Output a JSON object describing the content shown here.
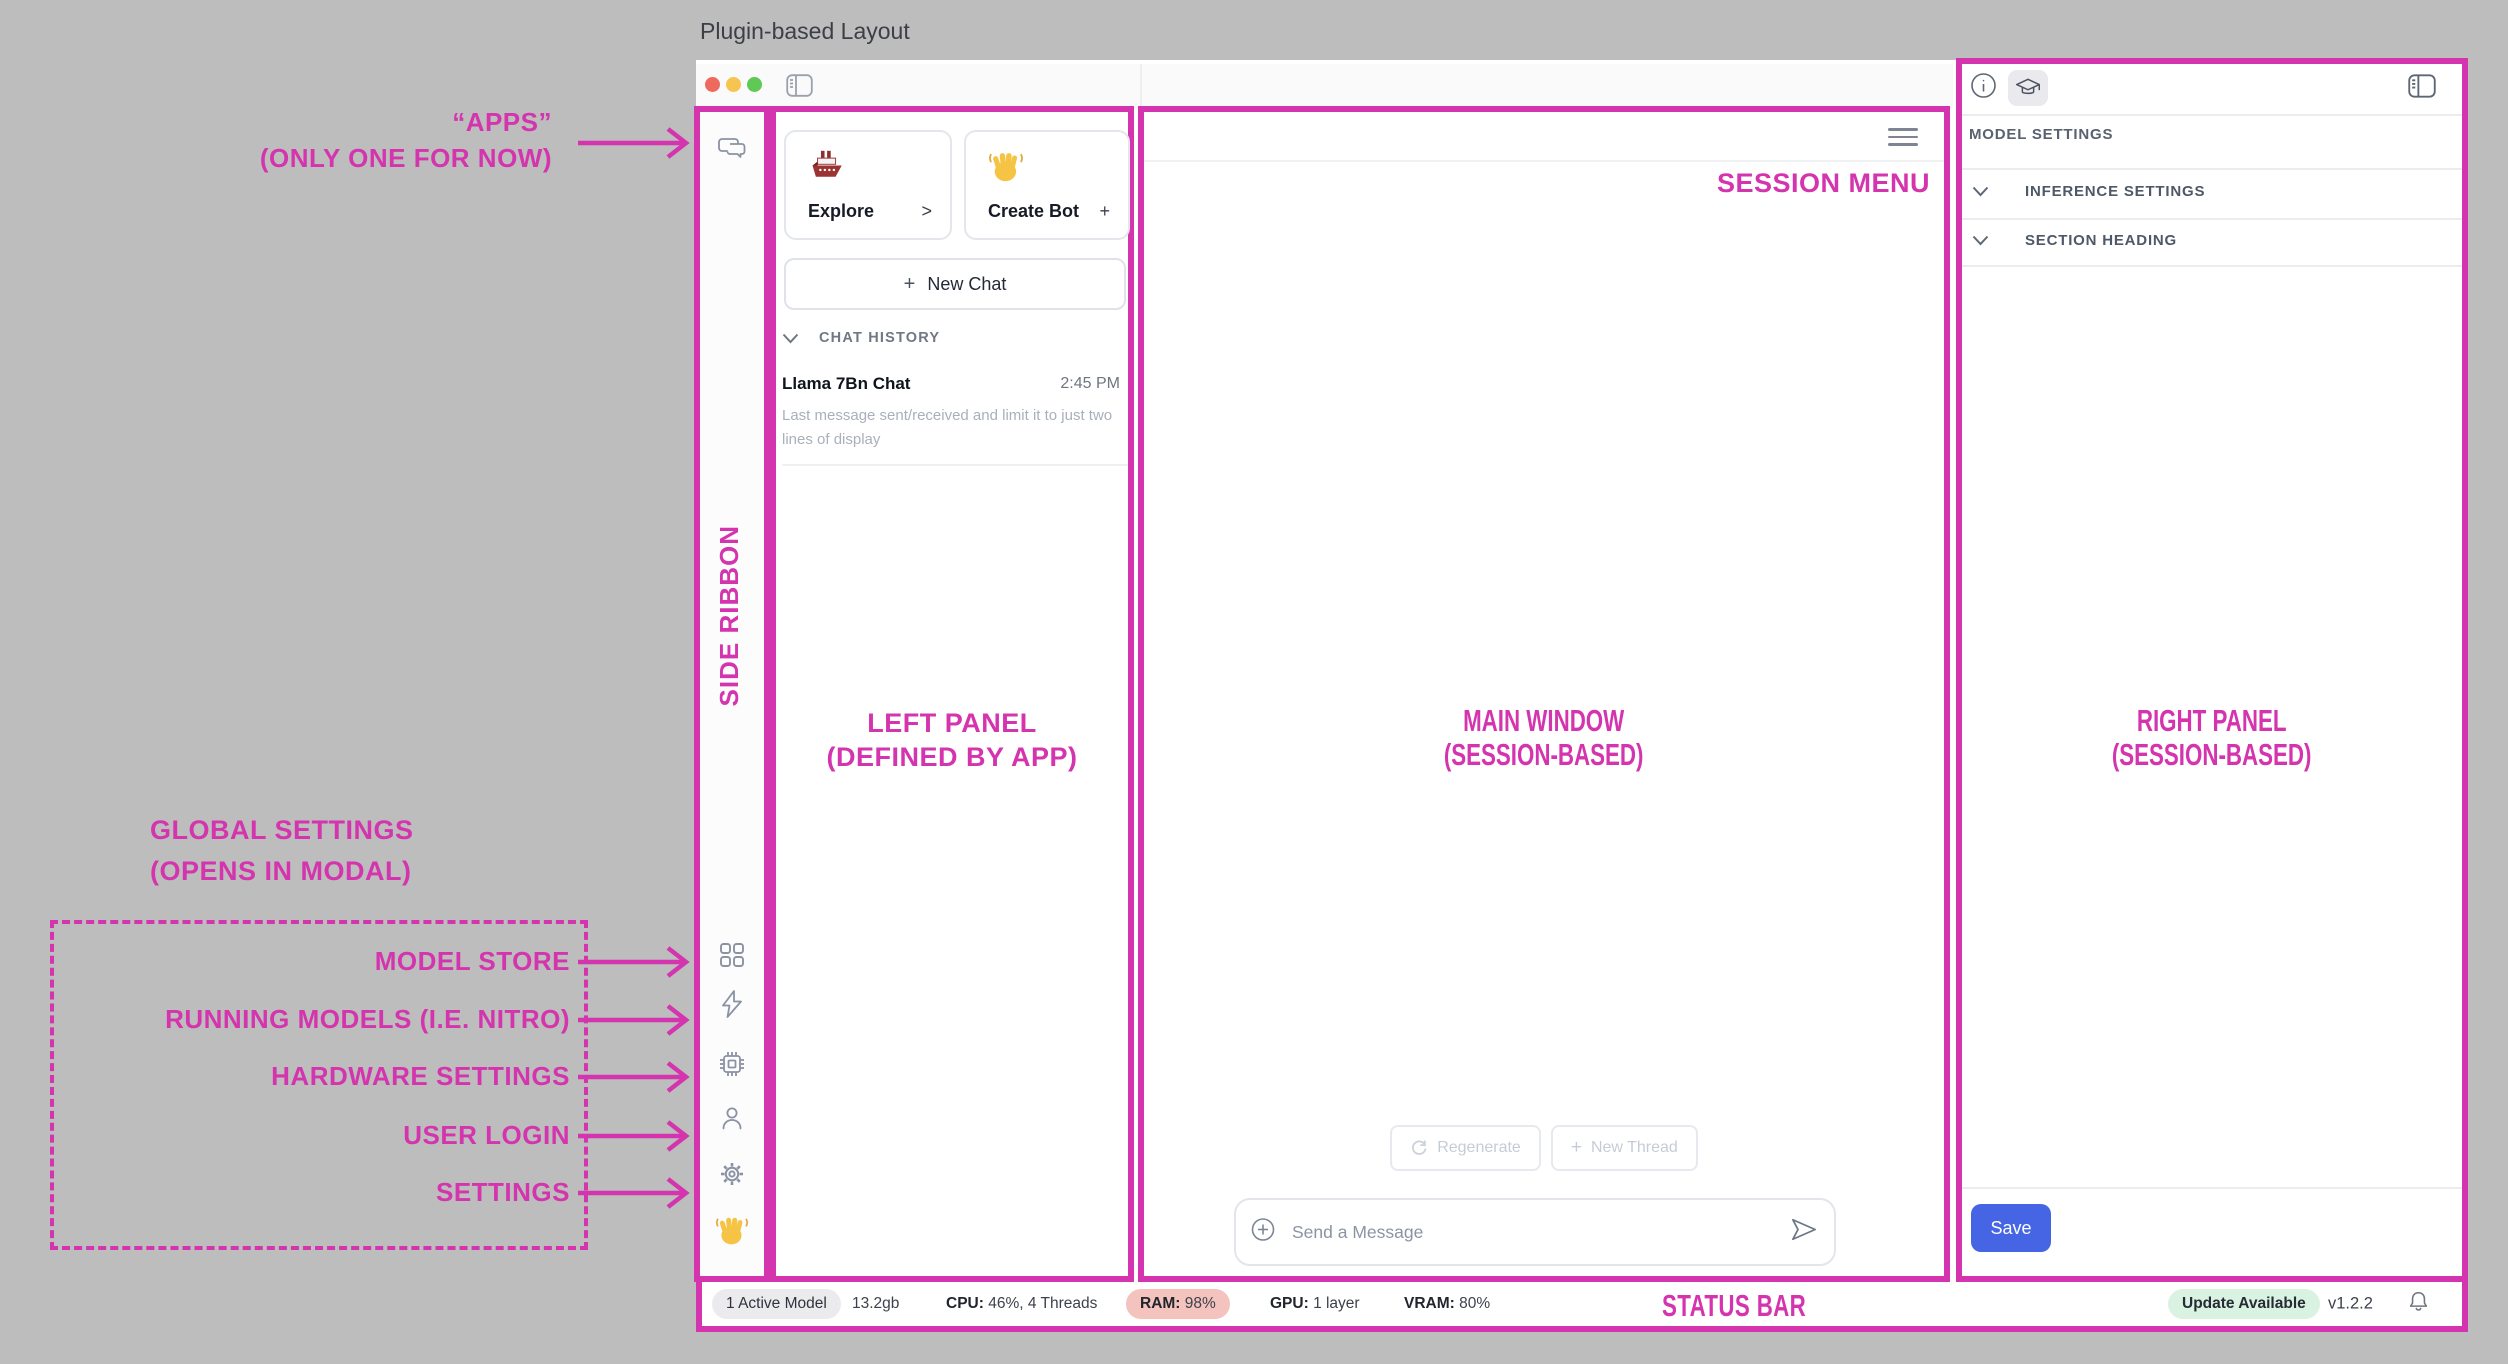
{
  "page_title": "Plugin-based Layout",
  "colors": {
    "accent_magenta": "#d434ad",
    "save_button_bg": "#4565e4",
    "ram_pill_bg": "#f4c3bd",
    "update_pill_bg": "#d9f2e2"
  },
  "annotations": {
    "apps_line1": "“APPS”",
    "apps_line2": "(ONLY ONE FOR NOW)",
    "side_ribbon": "SIDE RIBBON",
    "left_panel_line1": "LEFT PANEL",
    "left_panel_line2": "(DEFINED BY APP)",
    "main_window_line1": "MAIN WINDOW",
    "main_window_line2": "(SESSION-BASED)",
    "right_panel_line1": "RIGHT PANEL",
    "right_panel_line2": "(SESSION-BASED)",
    "session_menu": "SESSION MENU",
    "status_bar": "STATUS BAR",
    "global_settings_line1": "GLOBAL SETTINGS",
    "global_settings_line2": "(OPENS IN MODAL)",
    "global_items": [
      "MODEL STORE",
      "RUNNING MODELS (I.E. NITRO)",
      "HARDWARE SETTINGS",
      "USER LOGIN",
      "SETTINGS"
    ]
  },
  "left_panel": {
    "explore_card": {
      "label": "Explore",
      "affix": ">"
    },
    "create_bot_card": {
      "label": "Create Bot",
      "affix": "+"
    },
    "new_chat_plus": "+",
    "new_chat_label": "New Chat",
    "chat_history_heading": "CHAT HISTORY",
    "chat_item": {
      "title": "Llama 7Bn Chat",
      "time": "2:45 PM",
      "preview": "Last message sent/received and limit it to just two lines of display"
    }
  },
  "main": {
    "regenerate_label": "Regenerate",
    "new_thread_plus": "+",
    "new_thread_label": "New Thread",
    "message_placeholder": "Send a Message"
  },
  "right_panel": {
    "heading": "MODEL SETTINGS",
    "sections": [
      "INFERENCE SETTINGS",
      "SECTION HEADING"
    ],
    "save_label": "Save"
  },
  "status_bar": {
    "active_model": "1 Active Model",
    "memory_size": "13.2gb",
    "cpu_label": "CPU:",
    "cpu_value": "46%, 4 Threads",
    "ram_label": "RAM:",
    "ram_value": "98%",
    "gpu_label": "GPU:",
    "gpu_value": "1 layer",
    "vram_label": "VRAM:",
    "vram_value": "80%",
    "update_badge": "Update Available",
    "version": "v1.2.2"
  }
}
